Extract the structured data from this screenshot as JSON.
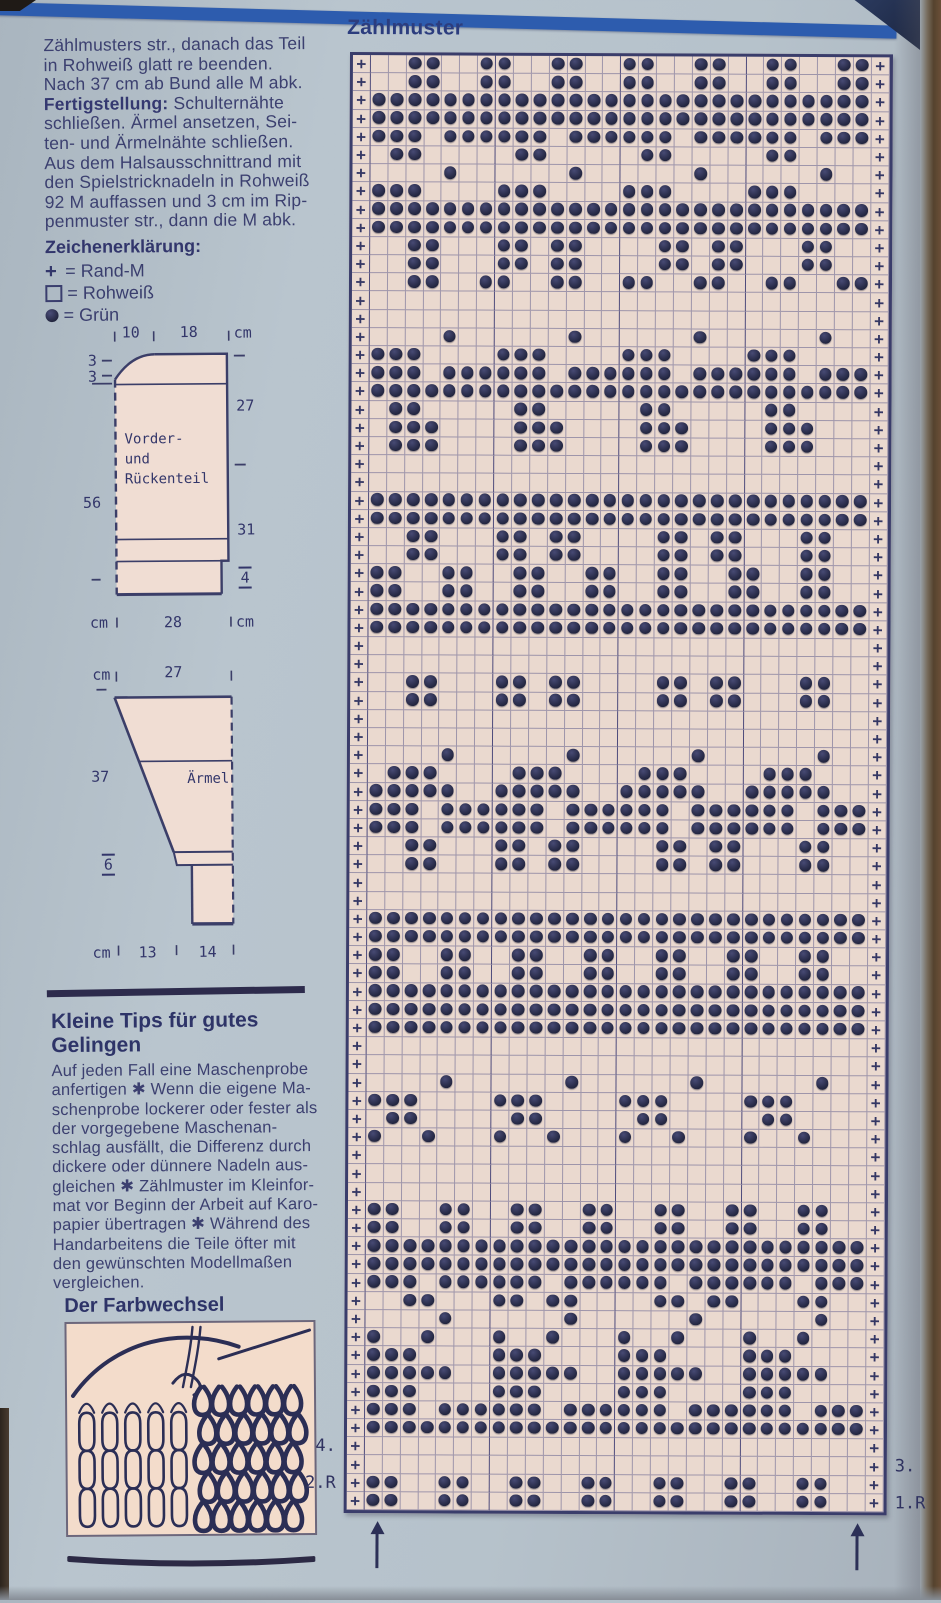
{
  "left_column": {
    "intro_lines": [
      {
        "text": "Zählmusters str., danach das Teil"
      },
      {
        "text": "in Rohweiß glatt re beenden."
      },
      {
        "text": "Nach 37 cm ab Bund alle M abk."
      },
      {
        "bold": "Fertigstellung:",
        "rest": " Schulternähte"
      },
      {
        "text": "schließen. Ärmel ansetzen, Sei-"
      },
      {
        "text": "ten- und Ärmelnähte schließen."
      },
      {
        "text": "Aus dem Halsausschnittrand mit"
      },
      {
        "text": "den Spielstricknadeln in Rohweiß"
      },
      {
        "text": "92 M auffassen und 3 cm im Rip-"
      },
      {
        "text": "penmuster str., dann die M abk."
      }
    ],
    "legend": {
      "heading": "Zeichenerklärung:",
      "items": [
        {
          "type": "plus",
          "symbol": "+",
          "text": "= Rand-M"
        },
        {
          "type": "square",
          "symbol": "□",
          "text": "= Rohweiß"
        },
        {
          "type": "dot",
          "symbol": "●",
          "text": "= Grün"
        }
      ]
    },
    "schematic_body": {
      "name_line1": "Vorder-",
      "name_line2": "und",
      "name_line3": "Rückenteil",
      "top_a": "10",
      "top_b": "18",
      "top_unit": "cm",
      "left_a": "3",
      "left_b": "3",
      "left_len": "56",
      "right_a": "27",
      "right_b": "31",
      "right_rib": "4",
      "bottom_unit_l": "cm",
      "bottom_w": "28",
      "bottom_unit_r": "cm"
    },
    "schematic_sleeve": {
      "name": "Ärmel",
      "top_unit": "cm",
      "top_w": "27",
      "left_len": "37",
      "rib_h": "6",
      "bottom_unit": "cm",
      "bottom_a": "13",
      "bottom_b": "14"
    },
    "tips": {
      "heading_line1": "Kleine Tips für gutes",
      "heading_line2": "Gelingen",
      "lines": [
        "Auf jeden Fall eine Maschenprobe",
        "anfertigen ✱ Wenn die eigene Ma-",
        "schenprobe lockerer oder fester als",
        "der vorgegebene Maschenan-",
        "schlag ausfällt, die Differenz durch",
        "dickere oder dünnere Nadeln aus-",
        "gleichen ✱ Zählmuster im Kleinfor-",
        "mat vor Beginn der Arbeit auf Karo-",
        "papier übertragen ✱ Während des",
        "Handarbeitens die Teile öfter mit",
        "den gewünschten Modellmaßen",
        "vergleichen."
      ]
    },
    "farbwechsel_heading": "Der Farbwechsel"
  },
  "chart": {
    "title": "Zählmuster",
    "edge_symbol": "+",
    "row_labels": {
      "left": [
        {
          "text": "4.",
          "row": 77
        },
        {
          "text": "2.R",
          "row": 79
        }
      ],
      "right": [
        {
          "text": "3.",
          "row": 78
        },
        {
          "text": "1.R",
          "row": 80
        }
      ]
    },
    "arrows_x": [
      382,
      862
    ],
    "colors": {
      "paper": "#ead9cf",
      "grid": "#5f5d8c",
      "dot": "#23263f",
      "border": "#3a3d6b",
      "symbol": "#343764"
    },
    "rows": [
      "..OO..OO..OO..OO..OO..OO..OO",
      "..OO..OO..OO..OO..OO..OO..OO",
      "OOOOOOOOOOOOOOOOOOOOOOOOOOOO",
      "OOOOOOOOOOOOOOOOOOOOOOOOOOOO",
      "OOO.OOOOOO.OOOOOO.OOOOOO.OOO",
      ".OO.....OO.....OO.....OO....",
      "....O......O......O......O..",
      "OOO....OOO....OOO....OOO....",
      "OOOOOOOOOOOOOOOOOOOOOOOOOOOO",
      "OOOOOOOOOOOOOOOOOOOOOOOOOOOO",
      "..OO...OO.OO....OO.OO...OO..",
      "..OO...OO.OO....OO.OO...OO..",
      "..OO..OO..OO..OO..OO..OO..OO",
      "............................",
      "............................",
      "....O......O......O......O..",
      "OOO....OOO....OOO....OOO....",
      "OOO.OOOOOO.OOOOOO.OOOOOO.OOO",
      "OOOOOOOOOOOOOOOOOOOOOOOOOOOO",
      ".OO.....OO.....OO.....OO....",
      ".OOO....OOO....OOO....OOO...",
      ".OOO....OOO....OOO....OOO...",
      "............................",
      "............................",
      "OOOOOOOOOOOOOOOOOOOOOOOOOOOO",
      "OOOOOOOOOOOOOOOOOOOOOOOOOOOO",
      "..OO...OO.OO....OO.OO...OO..",
      "..OO...OO.OO....OO.OO...OO..",
      "OO..OO..OO..OO..OO..OO..OO..",
      "OO..OO..OO..OO..OO..OO..OO..",
      "OOOOOOOOOOOOOOOOOOOOOOOOOOOO",
      "OOOOOOOOOOOOOOOOOOOOOOOOOOOO",
      "............................",
      "............................",
      "..OO...OO.OO....OO.OO...OO..",
      "..OO...OO.OO....OO.OO...OO..",
      "............................",
      "............................",
      "....O......O......O......O..",
      ".OOO....OOO....OOO....OOO...",
      "OOOOO..OOOOO..OOOOO..OOOOO..",
      "OOO.OOOOOO.OOOOOO.OOOOOO.OOO",
      "OOO.OOOOOO.OOOOOO.OOOOOO.OOO",
      "..OO...OO.OO....OO.OO...OO..",
      "..OO...OO.OO....OO.OO...OO..",
      "............................",
      "............................",
      "OOOOOOOOOOOOOOOOOOOOOOOOOOOO",
      "OOOOOOOOOOOOOOOOOOOOOOOOOOOO",
      "OO..OO..OO..OO..OO..OO..OO..",
      "OO..OO..OO..OO..OO..OO..OO..",
      "OOOOOOOOOOOOOOOOOOOOOOOOOOOO",
      "OOOOOOOOOOOOOOOOOOOOOOOOOOOO",
      "OOOOOOOOOOOOOOOOOOOOOOOOOOOO",
      "............................",
      "............................",
      "....O......O......O......O..",
      "OOO....OOO....OOO....OOO....",
      ".OO.....OO.....OO.....OO....",
      "O..O...O..O...O..O...O..O...",
      "............................",
      "............................",
      "............................",
      "OO..OO..OO..OO..OO..OO..OO..",
      "OO..OO..OO..OO..OO..OO..OO..",
      "OOOOOOOOOOOOOOOOOOOOOOOOOOOO",
      "OOOOOOOOOOOOOOOOOOOOOOOOOOOO",
      "OOO.OOOOOO.OOOOOO.OOOOOO.OOO",
      "..OO...OO.OO....OO.OO...OO..",
      "....O......O......O......O..",
      "O..O...O..O...O..O...O..O...",
      "OOO....OOO....OOO....OOO....",
      "OOOOO..OOOOO..OOOOO..OOOOO..",
      "OOO....OOO....OOO....OOO....",
      "OOO.OOOOOO.OOOOOO.OOOOOO.OOO",
      "OOOOOOOOOOOOOOOOOOOOOOOOOOOO",
      "............................",
      "............................",
      "OO..OO..OO..OO..OO..OO..OO..",
      "OO..OO..OO..OO..OO..OO..OO.."
    ]
  }
}
